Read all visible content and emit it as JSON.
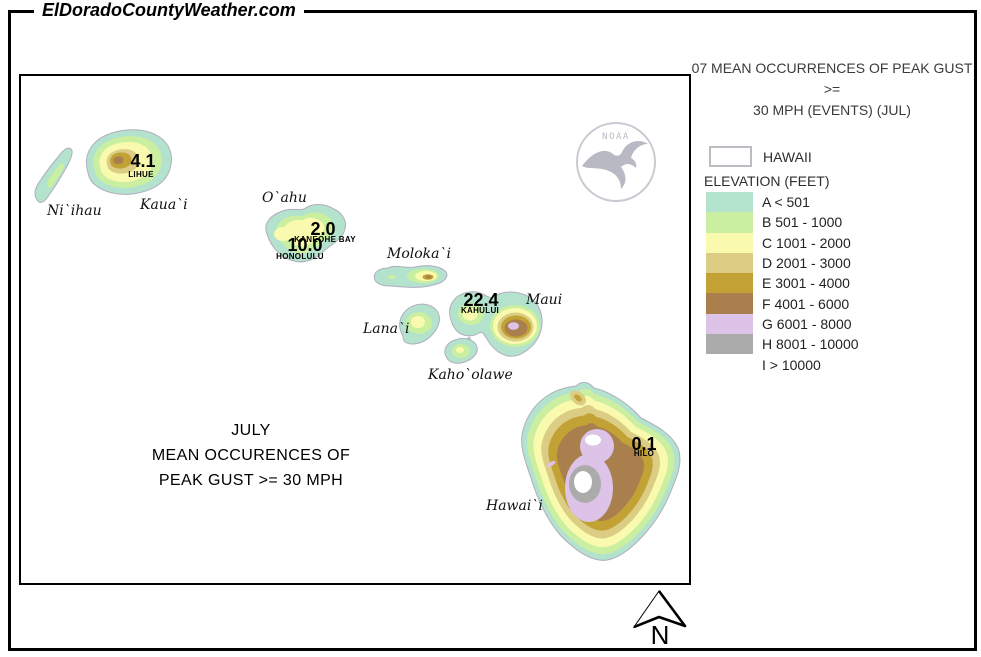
{
  "page": {
    "site_header": "ElDoradoCountyWeather.com"
  },
  "right_panel": {
    "title_line1": "07 MEAN OCCURRENCES OF PEAK GUST >=",
    "title_line2": "30 MPH (EVENTS) (JUL)",
    "region_box_label": "HAWAII",
    "legend_title": "ELEVATION (FEET)",
    "legend_items": [
      {
        "label": "A < 501",
        "color": "#b3e2cd"
      },
      {
        "label": "B 501 - 1000",
        "color": "#cbefa1"
      },
      {
        "label": "C 1001 - 2000",
        "color": "#fafaae"
      },
      {
        "label": "D 2001 - 3000",
        "color": "#dbcd84"
      },
      {
        "label": "E 3001 - 4000",
        "color": "#c2a135"
      },
      {
        "label": "F 4001 - 6000",
        "color": "#aa7f4e"
      },
      {
        "label": "G 6001 - 8000",
        "color": "#dcc3e7"
      },
      {
        "label": "H 8001 - 10000",
        "color": "#ababab"
      },
      {
        "label": "I > 10000",
        "color": "#ffffff"
      }
    ]
  },
  "map": {
    "title_lines": [
      "JULY",
      "MEAN OCCURENCES OF",
      "PEAK GUST >= 30 MPH"
    ],
    "noaa_logo_text": "NOAA",
    "north_label": "N",
    "island_labels": [
      "Ni`ihau",
      "Kaua`i",
      "O`ahu",
      "Moloka`i",
      "Lana`i",
      "Maui",
      "Kaho`olawe",
      "Hawai`i"
    ],
    "stations": [
      {
        "name": "LIHUE",
        "value": "4.1"
      },
      {
        "name": "KANEOHE BAY",
        "value": "2.0"
      },
      {
        "name": "HONOLULU",
        "value": "10.0"
      },
      {
        "name": "KAHULUI",
        "value": "22.4"
      },
      {
        "name": "HILO",
        "value": "0.1"
      }
    ]
  }
}
